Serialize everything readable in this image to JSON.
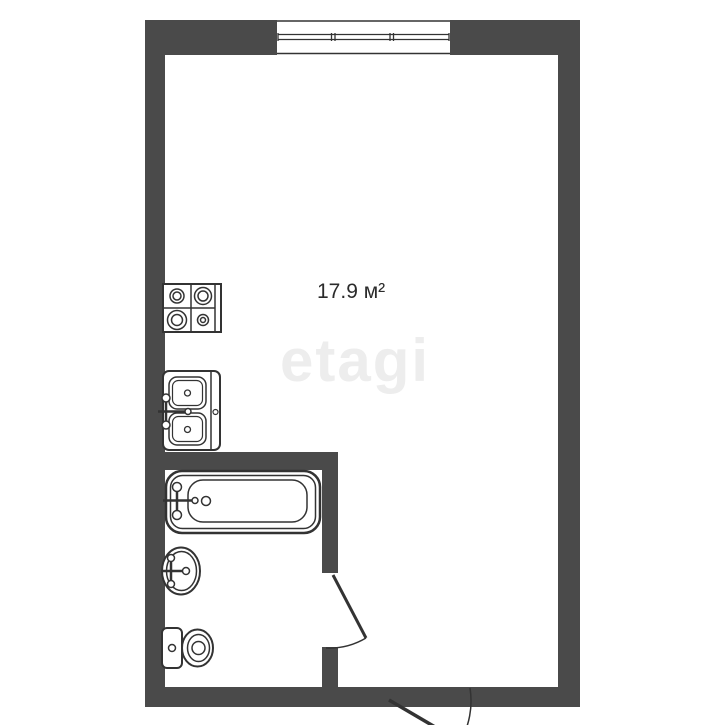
{
  "room": {
    "area_label": "17.9 м²"
  },
  "watermark": {
    "text": "etagi"
  },
  "colors": {
    "wall": "#4a4a4a",
    "outline": "#333333",
    "watermark": "#ededed",
    "label": "#2b2b2b",
    "background": "#ffffff"
  },
  "fixtures": [
    "window",
    "stove",
    "kitchen-sink",
    "bathtub",
    "washbasin",
    "toilet",
    "bathroom-door",
    "entrance-door"
  ]
}
